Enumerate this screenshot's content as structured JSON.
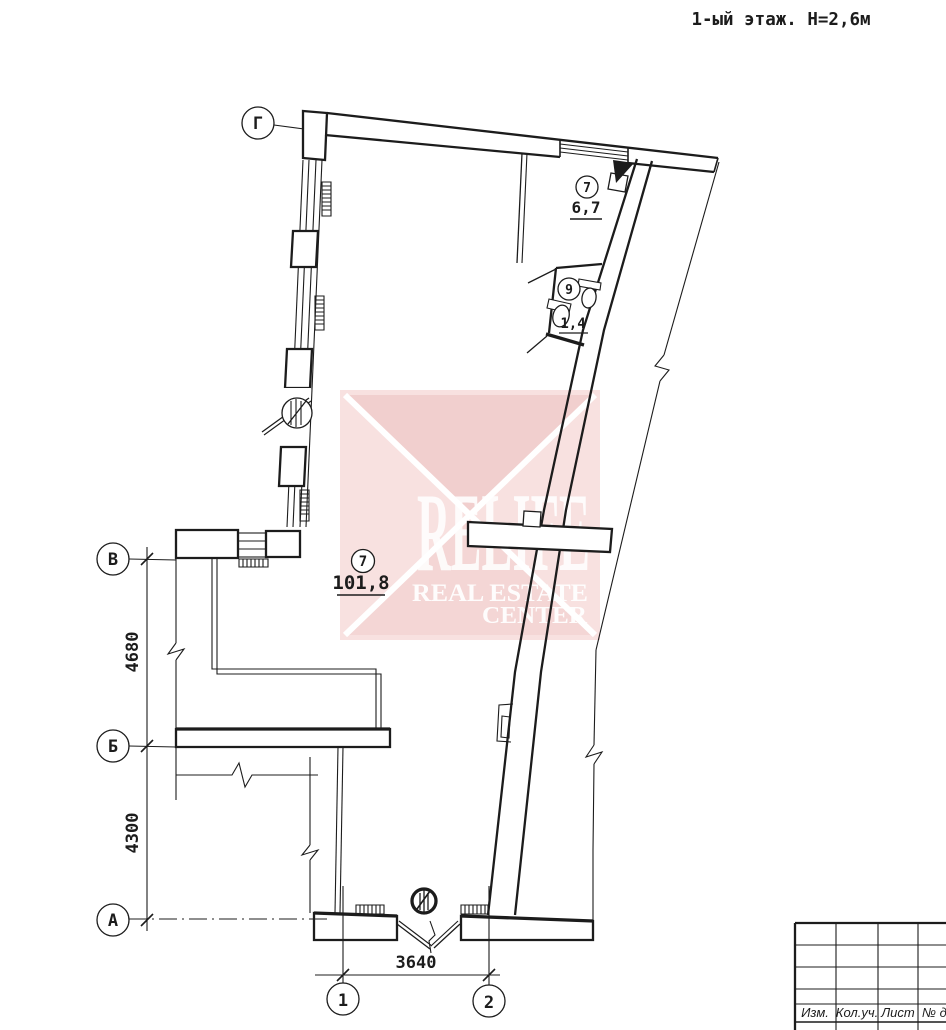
{
  "title": "1-ый этаж. Н=2,6м",
  "axis_labels": {
    "gamma": "Г",
    "v": "В",
    "b": "Б",
    "a": "А",
    "one": "1",
    "two": "2"
  },
  "dims": {
    "left_upper": "4680",
    "left_lower": "4300",
    "bottom": "3640"
  },
  "rooms": {
    "main": {
      "number": "7",
      "area": "101,8"
    },
    "hall": {
      "number": "7",
      "area": "6,7"
    },
    "wc": {
      "number": "9",
      "area": "1,4"
    }
  },
  "watermark": {
    "brand": "RELIFE",
    "line1": "REAL ESTATE",
    "line2": "CENTER"
  },
  "title_block": {
    "col1": "Изм.",
    "col2": "Кол.уч.",
    "col3": "Лист",
    "col4": "№ док"
  },
  "colors": {
    "line": "#1c1c1c",
    "paper": "#ffffff",
    "wm_base": "#f8e1e0",
    "wm_dark": "#f1cfce",
    "wm_mid": "#f4d6d5",
    "wm_text": "#ffffff"
  }
}
